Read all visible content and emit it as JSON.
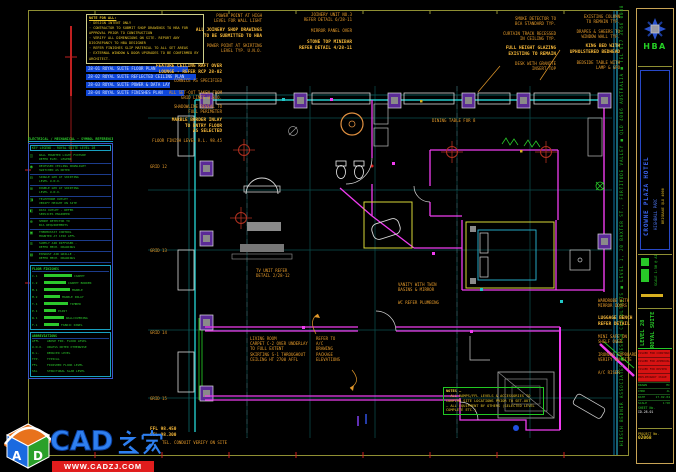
{
  "palette": {
    "background": "#000000",
    "border_yellow": "#8f8f33",
    "wall_magenta": "#f03cf0",
    "wall_cyan": "#22c8c8",
    "column_purple": "#5a2a96",
    "text_orange": "#e2982a",
    "text_green": "#2cc82c",
    "highlight_blue": "#0f46d8",
    "target_red": "#b03020",
    "watermark_blue": "#2e7ff0",
    "watermark_red": "#e01d1d"
  },
  "watermark": {
    "site_name": "CAD之家",
    "latin_part": "CAD",
    "site_url": "WWW.CADZJ.COM",
    "cube_letters": [
      "A",
      "D"
    ]
  },
  "general_notes": {
    "title": "NOTE FOR ALL:",
    "lines": [
      "· DESIGN INTENT ONLY",
      "· CONTRACTOR TO SUBMIT SHOP DRAWINGS TO HBA FOR APPROVAL PRIOR TO CONSTRUCTION",
      "· VERIFY ALL DIMENSIONS ON SITE. REPORT ANY DISCREPANCY TO HBA DESIGNER",
      "· REFER FINISHES SLIP MATERIAL TO ALL SET AREAS",
      "· EXTERNAL WINDOW & DOOR UPGRADES TO BE CONFIRMED BY ARCHITECT."
    ]
  },
  "drawing_index": [
    {
      "label": "28-01  ROYAL SUITE FLOOR PLAN",
      "w": 100
    },
    {
      "label": "28-02  ROYAL SUITE REFLECTED CEILING PLAN",
      "w": 108
    },
    {
      "label": "28-03  ROYAL SUITE POWER & DATA LAYOUT",
      "w": 82
    },
    {
      "label": "28-04  ROYAL SUITE FINISHES PLAN",
      "w": 96
    }
  ],
  "legend": {
    "title": "ELECTRICAL / MECHANICAL - SYMBOL REFERENCE",
    "subtitle": "KEY LEGEND - ROYAL SUITE LEVEL 28",
    "rows": [
      {
        "symbol": "◫",
        "text": "WALL MOUNTED LIGHT FIXTURE\nREFER ELEC. LEGEND"
      },
      {
        "symbol": "◉",
        "text": "RECESSED CEILING DOWNLIGHT\nSWITCHED AS NOTED"
      },
      {
        "symbol": "⊟",
        "text": "SINGLE GPO AT SKIRTING\nLEVEL U.N.O."
      },
      {
        "symbol": "⊞",
        "text": "DOUBLE GPO AT SKIRTING\nLEVEL U.N.O."
      },
      {
        "symbol": "◨",
        "text": "TELEPHONE OUTLET -\nVERIFY HEIGHT ON SITE"
      },
      {
        "symbol": "◧",
        "text": "DATA OUTLET - REFER\nSERVICES ENGINEER"
      },
      {
        "symbol": "⊚",
        "text": "SMOKE DETECTOR TO\nBCA REQUIREMENTS"
      },
      {
        "symbol": "▣",
        "text": "THERMOSTAT CONTROL\nMOUNTED AT 1350 AFFL"
      },
      {
        "symbol": "≋",
        "text": "SUPPLY AIR DIFFUSER -\nREFER MECH. DRAWINGS"
      },
      {
        "symbol": "▤",
        "text": "EXHAUST AIR GRILLE -\nREFER MECH. DRAWINGS"
      }
    ],
    "finishes": {
      "title": "FLOOR FINISHES",
      "rows": [
        {
          "code": "C-1",
          "name": "CARPET",
          "bar": 28
        },
        {
          "code": "C-2",
          "name": "CARPET BORDER",
          "bar": 22
        },
        {
          "code": "M-1",
          "name": "MARBLE",
          "bar": 26
        },
        {
          "code": "M-2",
          "name": "MARBLE INLAY",
          "bar": 16
        },
        {
          "code": "T-1",
          "name": "TIMBER",
          "bar": 24
        },
        {
          "code": "P-1",
          "name": "PAINT",
          "bar": 12
        },
        {
          "code": "W-1",
          "name": "WALLCOVERING",
          "bar": 20
        },
        {
          "code": "F-1",
          "name": "FABRIC PANEL",
          "bar": 15
        }
      ]
    },
    "abbreviations": {
      "title": "ABBREVIATIONS",
      "rows": [
        {
          "code": "AFFL",
          "name": "ABOVE FIN. FLOOR LEVEL"
        },
        {
          "code": "U.N.O.",
          "name": "UNLESS NOTED OTHERWISE"
        },
        {
          "code": "R.L.",
          "name": "REDUCED LEVEL"
        },
        {
          "code": "TYP.",
          "name": "TYPICAL"
        },
        {
          "code": "FFL",
          "name": "FINISHED FLOOR LEVEL"
        },
        {
          "code": "SSL",
          "name": "STRUCTURAL SLAB LEVEL"
        }
      ]
    }
  },
  "plan_notes": {
    "title": "NOTES –",
    "lines": [
      "– ALL RAMPS/FFL LEVELS & ACCESSORIES TO",
      "CONFIRM SITE LOCATIONS PRIOR TO SET-OUT",
      "– ALL EQUIPMENT BY OTHERS (SELECTED LEVEL",
      "COMPLETE ETC.)"
    ]
  },
  "consultant_strip": "HIRSCH BEDNER ASSOCIATES ■ DESIGN CONSULTANTS ■ LEVEL 1, 20 BAXTER ST., FORTITUDE VALLEY ■ QLD 4006 AUSTRALIA ■ TEL 617 3666 0088",
  "annotations": [
    {
      "x": 262,
      "y": 13,
      "align": "right",
      "text": "POWER POINT AT HIGH\nLEVEL FOR WALL LIGHT"
    },
    {
      "x": 262,
      "y": 28,
      "align": "right",
      "bold": true,
      "text": "ALL JOINERY SHOP DRAWINGS\nTO BE SUBMITTED TO HBA"
    },
    {
      "x": 262,
      "y": 43,
      "align": "right",
      "text": "POWER POINT AT SKIRTING\nLEVEL TYP. U.N.O."
    },
    {
      "x": 222,
      "y": 64,
      "align": "right",
      "bold": true,
      "text": "FEATURE CEILING RAFT OVER\nLOUNGE - REFER RCP 28-02"
    },
    {
      "x": 222,
      "y": 78,
      "align": "right",
      "text": "CORNICE AS SPECIFIED"
    },
    {
      "x": 222,
      "y": 90,
      "align": "right",
      "text": "ALL SET-OUT TAKEN FROM\nGRID LINES U.N.O."
    },
    {
      "x": 222,
      "y": 104,
      "align": "right",
      "text": "SHADOWLINE REVEAL TO\nFULL PERIMETER"
    },
    {
      "x": 222,
      "y": 118,
      "align": "right",
      "bold": true,
      "text": "MARBLE BORDER INLAY\nTO ENTRY FLOOR\nAS SELECTED"
    },
    {
      "x": 222,
      "y": 138,
      "align": "right",
      "text": "FLOOR FINISH LEVEL R.L. 98.45"
    },
    {
      "x": 352,
      "y": 12,
      "align": "right",
      "text": "JOINERY UNIT NO.3\nREFER DETAIL 6/28-11"
    },
    {
      "x": 352,
      "y": 28,
      "align": "right",
      "text": "MIRROR PANEL OVER"
    },
    {
      "x": 352,
      "y": 40,
      "align": "right",
      "bold": true,
      "text": "STONE TOP MINIBAR\nREFER DETAIL 4/28-11"
    },
    {
      "x": 556,
      "y": 16,
      "align": "right",
      "text": "SMOKE DETECTOR TO\nBCA STANDARD TYP."
    },
    {
      "x": 556,
      "y": 31,
      "align": "right",
      "text": "CURTAIN TRACK RECESSED\nIN CEILING TYP."
    },
    {
      "x": 556,
      "y": 46,
      "align": "right",
      "bold": true,
      "text": "FULL HEIGHT GLAZING\nEXISTING TO REMAIN"
    },
    {
      "x": 556,
      "y": 61,
      "align": "right",
      "text": "DESK WITH GRANITE\nINSERT TOP"
    },
    {
      "x": 620,
      "y": 14,
      "align": "right",
      "text": "EXISTING COLUMN\nTO REMAIN TYP."
    },
    {
      "x": 620,
      "y": 29,
      "align": "right",
      "text": "DRAPES & SHEERS TO\nWINDOW WALL TYP."
    },
    {
      "x": 620,
      "y": 44,
      "align": "right",
      "bold": true,
      "text": "KING BED WITH\nUPHOLSTERED BEDHEAD"
    },
    {
      "x": 620,
      "y": 60,
      "align": "right",
      "text": "BEDSIDE TABLE WITH\nLAMP & GPO"
    },
    {
      "x": 598,
      "y": 298,
      "text": "WARDROBE WITH\nMIRROR DOORS"
    },
    {
      "x": 598,
      "y": 316,
      "bold": true,
      "text": "LUGGAGE BENCH\nREFER DETAIL"
    },
    {
      "x": 598,
      "y": 334,
      "text": "MINI SAFE ON\nSHELF OVER"
    },
    {
      "x": 598,
      "y": 352,
      "text": "IRONING CUPBOARD\nVERIFY ON SITE"
    },
    {
      "x": 598,
      "y": 370,
      "text": "A/C RISER"
    },
    {
      "x": 150,
      "y": 164,
      "text": "GRID 12"
    },
    {
      "x": 150,
      "y": 248,
      "text": "GRID 13"
    },
    {
      "x": 150,
      "y": 330,
      "text": "GRID 14"
    },
    {
      "x": 150,
      "y": 396,
      "text": "GRID 15"
    },
    {
      "x": 150,
      "y": 427,
      "bold": true,
      "text": "FFL 98.450\nSSL 98.300"
    },
    {
      "x": 162,
      "y": 440,
      "text": "TEL. CONDUIT VERIFY ON SITE"
    },
    {
      "x": 250,
      "y": 336,
      "text": "LIVING ROOM\nCARPET C-2 OVER UNDERLAY\nTO FULL EXTENT\nSKIRTING S-1 THROUGHOUT\nCEILING HT 2700 AFFL"
    },
    {
      "x": 316,
      "y": 336,
      "text": "REFER TO\nA/C\nDRAWING\nPACKAGE\nELEVATIONS"
    },
    {
      "x": 398,
      "y": 282,
      "text": "VANITY WITH TWIN\nBASINS & MIRROR"
    },
    {
      "x": 398,
      "y": 300,
      "text": "WC REFER PLUMBING"
    },
    {
      "x": 432,
      "y": 118,
      "text": "DINING TABLE FOR 8"
    },
    {
      "x": 256,
      "y": 268,
      "text": "TV UNIT REFER\nDETAIL 2/28-12"
    }
  ],
  "title_block": {
    "logo_text": "HBA",
    "client": "CROWNE PLAZA HOTEL",
    "project": "HIGHBALL PARC",
    "address": "BRISBANE QLD 4000",
    "scale_note": "SCALE 1:50 @ A1",
    "level": "LEVEL 28",
    "suite": "ROYAL SUITE",
    "revisions": [
      "ISSUED FOR CONSTRUCTION",
      "ISSUED FOR APPROVAL",
      "ISSUED FOR REVIEW",
      "PRELIMINARY ISSUE"
    ],
    "info_rows": [
      {
        "label": "DRAWN",
        "value": "MC"
      },
      {
        "label": "CHKD",
        "value": "JL"
      },
      {
        "label": "DATE",
        "value": "17.02.04"
      },
      {
        "label": "SCALE",
        "value": "1:50"
      }
    ],
    "sheet_label": "SHEET No.",
    "sheet_number": "ID-28.01",
    "project_label": "PROJECT No.",
    "project_number": "02068"
  }
}
